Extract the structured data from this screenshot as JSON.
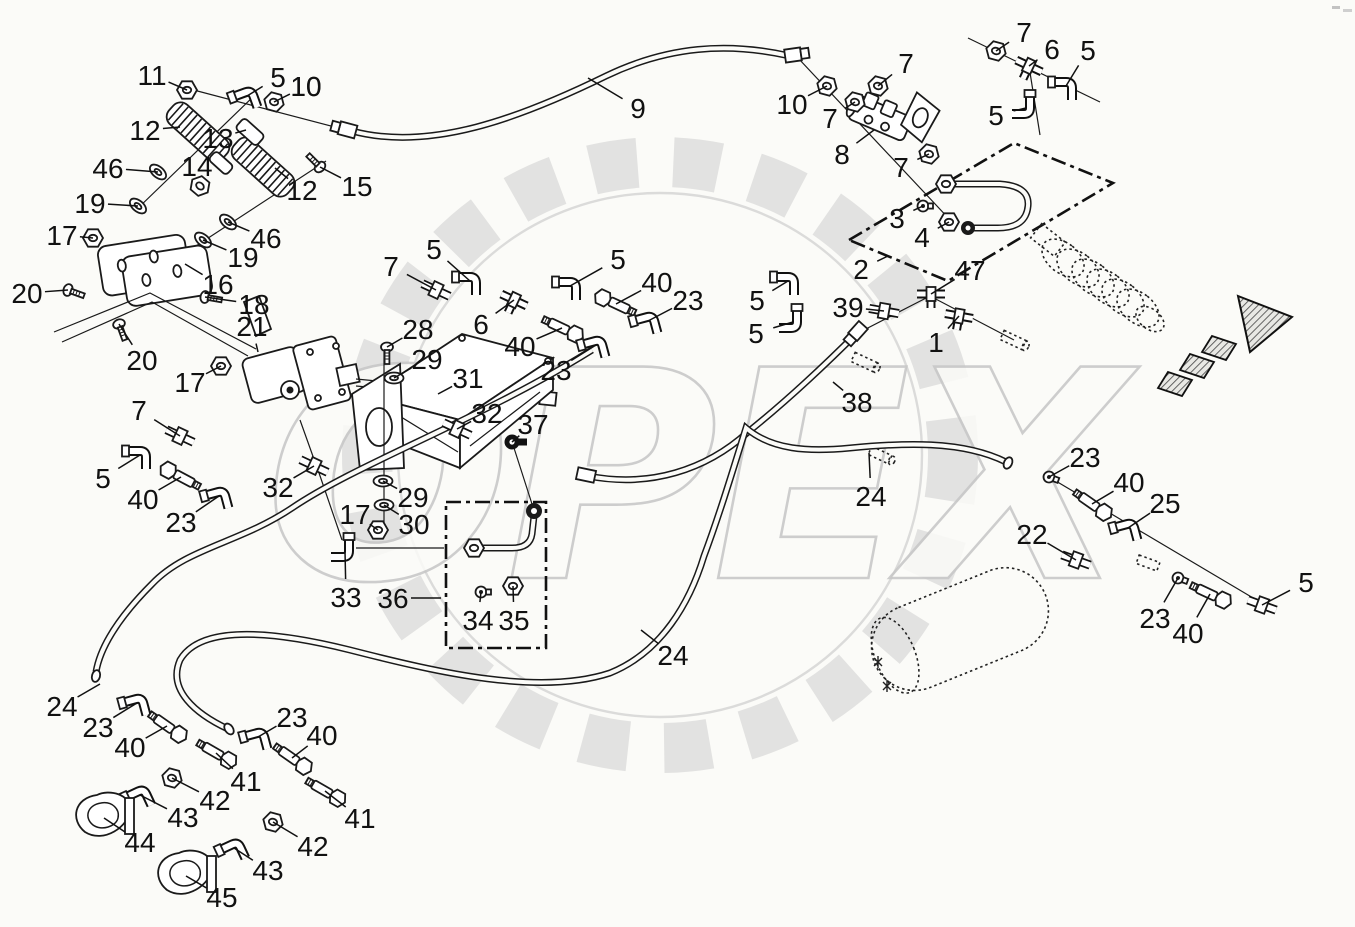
{
  "watermark": {
    "text": "OPEX"
  },
  "diagram": {
    "type": "exploded-parts-diagram",
    "labels": [
      {
        "t": "11",
        "x": 152,
        "y": 75,
        "lx": 187,
        "ly": 90,
        "k": "nut",
        "r": 0
      },
      {
        "t": "5",
        "x": 278,
        "y": 77,
        "lx": 247,
        "ly": 96,
        "k": "elbow",
        "r": -20
      },
      {
        "t": "10",
        "x": 306,
        "y": 86,
        "lx": 827,
        "ly": 0,
        "k": "none"
      },
      {
        "t": "10",
        "x": 306,
        "y": 86,
        "lx": 274,
        "ly": 102,
        "k": "nut",
        "r": 15
      },
      {
        "t": "12",
        "x": 145,
        "y": 130,
        "lx": 180,
        "ly": 127,
        "k": "none"
      },
      {
        "t": "13",
        "x": 218,
        "y": 138,
        "lx": 246,
        "ly": 130,
        "k": "none"
      },
      {
        "t": "46",
        "x": 108,
        "y": 168,
        "lx": 158,
        "ly": 172,
        "k": "washer",
        "r": 40
      },
      {
        "t": "14",
        "x": 197,
        "y": 166,
        "lx": 200,
        "ly": 186,
        "k": "nut",
        "r": 40
      },
      {
        "t": "19",
        "x": 90,
        "y": 203,
        "lx": 138,
        "ly": 206,
        "k": "washer",
        "r": 40
      },
      {
        "t": "15",
        "x": 357,
        "y": 186,
        "lx": 320,
        "ly": 167,
        "k": "screw",
        "r": 135
      },
      {
        "t": "12",
        "x": 302,
        "y": 190,
        "lx": 275,
        "ly": 168,
        "k": "none"
      },
      {
        "t": "17",
        "x": 62,
        "y": 235,
        "lx": 93,
        "ly": 238,
        "k": "nut",
        "r": 0
      },
      {
        "t": "46",
        "x": 266,
        "y": 238,
        "lx": 228,
        "ly": 222,
        "k": "washer",
        "r": 40
      },
      {
        "t": "19",
        "x": 243,
        "y": 257,
        "lx": 203,
        "ly": 240,
        "k": "washer",
        "r": 40
      },
      {
        "t": "20",
        "x": 27,
        "y": 293,
        "lx": 68,
        "ly": 290,
        "k": "screw",
        "r": -70
      },
      {
        "t": "16",
        "x": 218,
        "y": 284,
        "lx": 185,
        "ly": 264,
        "k": "none"
      },
      {
        "t": "18",
        "x": 254,
        "y": 304,
        "lx": 205,
        "ly": 297,
        "k": "screw",
        "r": -80
      },
      {
        "t": "21",
        "x": 252,
        "y": 326,
        "lx": 258,
        "ly": 352,
        "k": "none"
      },
      {
        "t": "20",
        "x": 142,
        "y": 360,
        "lx": 119,
        "ly": 324,
        "k": "screw",
        "r": -20
      },
      {
        "t": "17",
        "x": 190,
        "y": 382,
        "lx": 221,
        "ly": 366,
        "k": "nut",
        "r": 0
      },
      {
        "t": "7",
        "x": 391,
        "y": 266,
        "lx": 436,
        "ly": 290,
        "k": "straight",
        "r": 25
      },
      {
        "t": "5",
        "x": 434,
        "y": 249,
        "lx": 470,
        "ly": 281,
        "k": "elbow",
        "r": 0
      },
      {
        "t": "6",
        "x": 481,
        "y": 324,
        "lx": 514,
        "ly": 300,
        "k": "tee",
        "r": 25
      },
      {
        "t": "5",
        "x": 618,
        "y": 259,
        "lx": 570,
        "ly": 286,
        "k": "elbow",
        "r": 0
      },
      {
        "t": "40",
        "x": 657,
        "y": 282,
        "lx": 616,
        "ly": 304,
        "k": "bolt",
        "r": 25
      },
      {
        "t": "23",
        "x": 688,
        "y": 300,
        "lx": 648,
        "ly": 321,
        "k": "elbow",
        "r": -15
      },
      {
        "t": "28",
        "x": 418,
        "y": 329,
        "lx": 387,
        "ly": 347,
        "k": "screw",
        "r": 0
      },
      {
        "t": "29",
        "x": 427,
        "y": 359,
        "lx": 394,
        "ly": 378,
        "k": "washer",
        "r": 0
      },
      {
        "t": "31",
        "x": 468,
        "y": 378,
        "lx": 438,
        "ly": 394,
        "k": "none"
      },
      {
        "t": "40",
        "x": 520,
        "y": 346,
        "lx": 562,
        "ly": 328,
        "k": "bolt",
        "r": 205
      },
      {
        "t": "23",
        "x": 556,
        "y": 370,
        "lx": 596,
        "ly": 345,
        "k": "elbow",
        "r": -15
      },
      {
        "t": "32",
        "x": 487,
        "y": 413,
        "lx": 457,
        "ly": 429,
        "k": "straight",
        "r": 25
      },
      {
        "t": "37",
        "x": 533,
        "y": 424,
        "lx": 512,
        "ly": 442,
        "k": "banjo",
        "r": 0
      },
      {
        "t": "32",
        "x": 278,
        "y": 487,
        "lx": 314,
        "ly": 466,
        "k": "straight",
        "r": 25
      },
      {
        "t": "29",
        "x": 413,
        "y": 497,
        "lx": 383,
        "ly": 481,
        "k": "washer",
        "r": 0
      },
      {
        "t": "17",
        "x": 355,
        "y": 514,
        "lx": 378,
        "ly": 530,
        "k": "nut",
        "r": 0
      },
      {
        "t": "30",
        "x": 414,
        "y": 524,
        "lx": 384,
        "ly": 505,
        "k": "washer",
        "r": 0
      },
      {
        "t": "7",
        "x": 139,
        "y": 410,
        "lx": 180,
        "ly": 436,
        "k": "straight",
        "r": 25
      },
      {
        "t": "5",
        "x": 103,
        "y": 478,
        "lx": 140,
        "ly": 455,
        "k": "elbow",
        "r": 0
      },
      {
        "t": "40",
        "x": 143,
        "y": 499,
        "lx": 181,
        "ly": 477,
        "k": "bolt",
        "r": 28
      },
      {
        "t": "23",
        "x": 181,
        "y": 522,
        "lx": 219,
        "ly": 496,
        "k": "elbow",
        "r": -15
      },
      {
        "t": "33",
        "x": 346,
        "y": 597,
        "lx": 345,
        "ly": 551,
        "k": "elbow",
        "r": 90
      },
      {
        "t": "36",
        "x": 393,
        "y": 598,
        "lx": 441,
        "ly": 598,
        "k": "none"
      },
      {
        "t": "34",
        "x": 478,
        "y": 620,
        "lx": 481,
        "ly": 592,
        "k": "plug",
        "r": 0
      },
      {
        "t": "35",
        "x": 514,
        "y": 620,
        "lx": 513,
        "ly": 586,
        "k": "nut",
        "r": 0
      },
      {
        "t": "24",
        "x": 62,
        "y": 706,
        "lx": 100,
        "ly": 684,
        "k": "none"
      },
      {
        "t": "23",
        "x": 98,
        "y": 727,
        "lx": 137,
        "ly": 703,
        "k": "elbow",
        "r": -15
      },
      {
        "t": "40",
        "x": 130,
        "y": 747,
        "lx": 167,
        "ly": 726,
        "k": "bolt",
        "r": 215
      },
      {
        "t": "23",
        "x": 292,
        "y": 717,
        "lx": 258,
        "ly": 737,
        "k": "elbow",
        "r": -15
      },
      {
        "t": "40",
        "x": 322,
        "y": 735,
        "lx": 292,
        "ly": 758,
        "k": "bolt",
        "r": 215
      },
      {
        "t": "41",
        "x": 246,
        "y": 781,
        "lx": 216,
        "ly": 753,
        "k": "bolt",
        "r": 210
      },
      {
        "t": "42",
        "x": 215,
        "y": 800,
        "lx": 172,
        "ly": 778,
        "k": "nut",
        "r": 15
      },
      {
        "t": "43",
        "x": 183,
        "y": 817,
        "lx": 140,
        "ly": 795,
        "k": "elbow",
        "r": -25
      },
      {
        "t": "44",
        "x": 140,
        "y": 842,
        "lx": 104,
        "ly": 818,
        "k": "clamp",
        "r": 0
      },
      {
        "t": "41",
        "x": 360,
        "y": 818,
        "lx": 325,
        "ly": 791,
        "k": "bolt",
        "r": 210
      },
      {
        "t": "42",
        "x": 313,
        "y": 846,
        "lx": 273,
        "ly": 822,
        "k": "nut",
        "r": 15
      },
      {
        "t": "43",
        "x": 268,
        "y": 870,
        "lx": 234,
        "ly": 848,
        "k": "elbow",
        "r": -25
      },
      {
        "t": "45",
        "x": 222,
        "y": 897,
        "lx": 186,
        "ly": 876,
        "k": "clamp",
        "r": 0
      },
      {
        "t": "9",
        "x": 638,
        "y": 108,
        "lx": 588,
        "ly": 78,
        "k": "none"
      },
      {
        "t": "10",
        "x": 792,
        "y": 104,
        "lx": 827,
        "ly": 86,
        "k": "nut",
        "r": 15
      },
      {
        "t": "7",
        "x": 906,
        "y": 63,
        "lx": 878,
        "ly": 86,
        "k": "nut",
        "r": 15
      },
      {
        "t": "7",
        "x": 830,
        "y": 118,
        "lx": 855,
        "ly": 102,
        "k": "nut",
        "r": 15
      },
      {
        "t": "8",
        "x": 842,
        "y": 154,
        "lx": 874,
        "ly": 130,
        "k": "none"
      },
      {
        "t": "7",
        "x": 901,
        "y": 167,
        "lx": 929,
        "ly": 154,
        "k": "nut",
        "r": 15
      },
      {
        "t": "3",
        "x": 897,
        "y": 218,
        "lx": 923,
        "ly": 206,
        "k": "plug",
        "r": 0
      },
      {
        "t": "4",
        "x": 922,
        "y": 237,
        "lx": 949,
        "ly": 222,
        "k": "nut",
        "r": 0
      },
      {
        "t": "2",
        "x": 861,
        "y": 269,
        "lx": 888,
        "ly": 256,
        "k": "none"
      },
      {
        "t": "47",
        "x": 970,
        "y": 270,
        "lx": 931,
        "ly": 294,
        "k": "tee",
        "r": 0
      },
      {
        "t": "7",
        "x": 1024,
        "y": 32,
        "lx": 996,
        "ly": 51,
        "k": "nut",
        "r": 15
      },
      {
        "t": "6",
        "x": 1052,
        "y": 49,
        "lx": 1029,
        "ly": 66,
        "k": "tee",
        "r": 25
      },
      {
        "t": "5",
        "x": 1088,
        "y": 50,
        "lx": 1066,
        "ly": 86,
        "k": "elbow",
        "r": 0
      },
      {
        "t": "5",
        "x": 996,
        "y": 115,
        "lx": 1026,
        "ly": 108,
        "k": "elbow",
        "r": 90
      },
      {
        "t": "5",
        "x": 757,
        "y": 300,
        "lx": 788,
        "ly": 281,
        "k": "elbow",
        "r": 0
      },
      {
        "t": "39",
        "x": 848,
        "y": 307,
        "lx": 884,
        "ly": 311,
        "k": "straight",
        "r": 10
      },
      {
        "t": "5",
        "x": 756,
        "y": 333,
        "lx": 793,
        "ly": 322,
        "k": "elbow",
        "r": 90
      },
      {
        "t": "1",
        "x": 936,
        "y": 342,
        "lx": 959,
        "ly": 316,
        "k": "tee",
        "r": 10
      },
      {
        "t": "38",
        "x": 857,
        "y": 402,
        "lx": 833,
        "ly": 382,
        "k": "none"
      },
      {
        "t": "24",
        "x": 871,
        "y": 496,
        "lx": 869,
        "ly": 453,
        "k": "none"
      },
      {
        "t": "23",
        "x": 1085,
        "y": 457,
        "lx": 1049,
        "ly": 477,
        "k": "plug",
        "r": 20
      },
      {
        "t": "40",
        "x": 1129,
        "y": 482,
        "lx": 1092,
        "ly": 504,
        "k": "bolt",
        "r": 215
      },
      {
        "t": "25",
        "x": 1165,
        "y": 503,
        "lx": 1128,
        "ly": 528,
        "k": "elbow",
        "r": -15
      },
      {
        "t": "22",
        "x": 1032,
        "y": 534,
        "lx": 1076,
        "ly": 560,
        "k": "straight",
        "r": 20
      },
      {
        "t": "23",
        "x": 1155,
        "y": 618,
        "lx": 1178,
        "ly": 578,
        "k": "plug",
        "r": 20
      },
      {
        "t": "40",
        "x": 1188,
        "y": 633,
        "lx": 1210,
        "ly": 594,
        "k": "bolt",
        "r": 205
      },
      {
        "t": "5",
        "x": 1306,
        "y": 582,
        "lx": 1262,
        "ly": 605,
        "k": "straight",
        "r": 20
      },
      {
        "t": "24",
        "x": 673,
        "y": 655,
        "lx": 641,
        "ly": 630,
        "k": "none"
      }
    ]
  }
}
